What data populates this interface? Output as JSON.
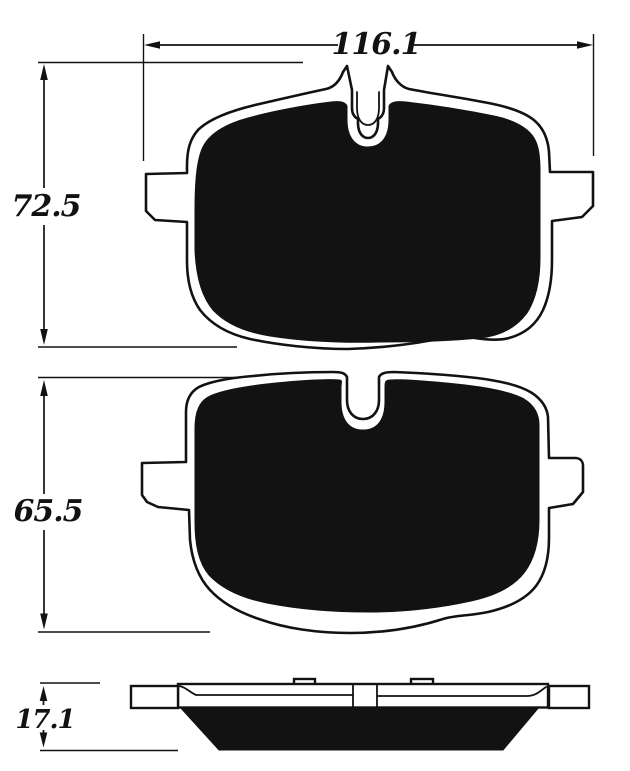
{
  "diagram": {
    "colors": {
      "ink": "#121212",
      "background": "#ffffff"
    },
    "dimensions": {
      "pad1_width": "116.1",
      "pad1_height": "72.5",
      "pad2_height": "65.5",
      "side_thickness": "17.1"
    }
  }
}
